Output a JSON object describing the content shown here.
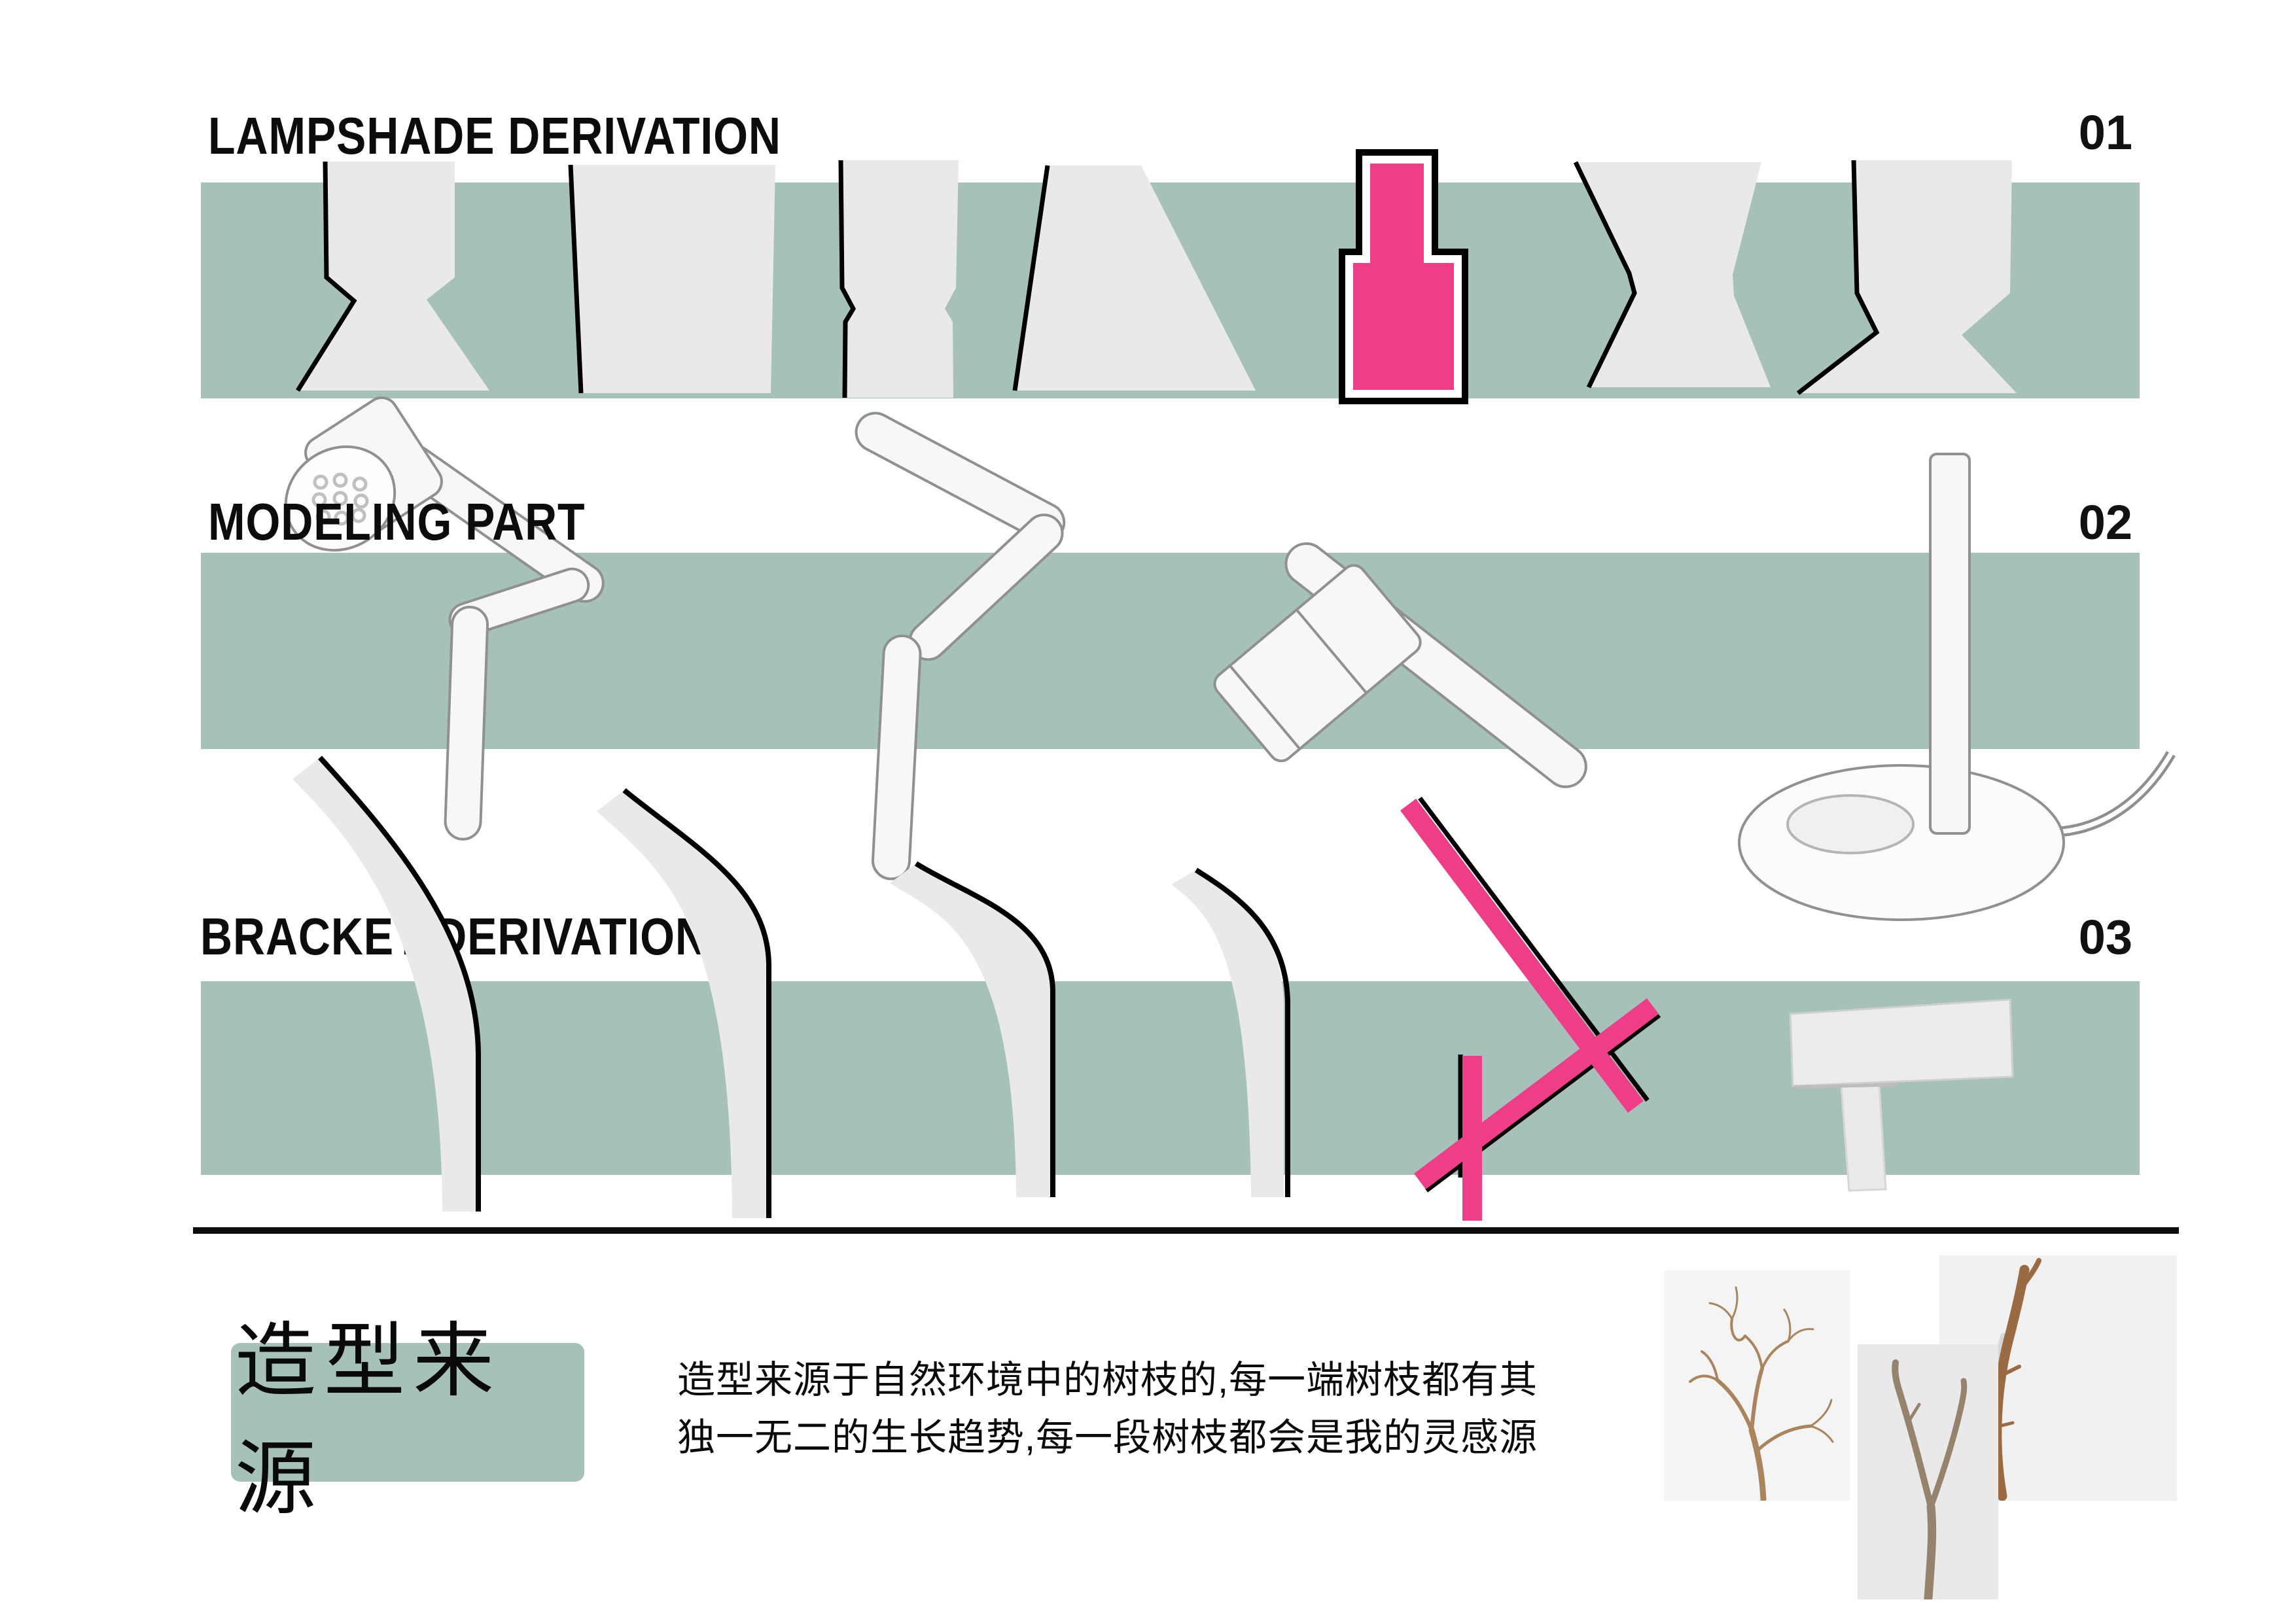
{
  "board": {
    "sections": [
      {
        "number": "01",
        "title": "LAMPSHADE DERIVATION"
      },
      {
        "number": "02",
        "title": "MODELING PART"
      },
      {
        "number": "03",
        "title": "BRACKET DERIVATION"
      }
    ],
    "footer": {
      "label": "造型来源",
      "description": [
        "造型来源于自然环境中的树枝的,每一端树枝都有其",
        "独一无二的生长趋势,每一段树枝都会是我的灵感源"
      ],
      "photos": [
        "dry-branch-many-twigs",
        "forked-y-branch",
        "single-stick-branch"
      ]
    },
    "colors": {
      "band_teal": "#a6c1ba",
      "shape_gray": "#e9e9e9",
      "highlight_pink": "#ee3e88",
      "outline_black": "#000000",
      "render_white": "#f7f7f7",
      "photo_bg_light": "#f4f4f4",
      "photo_bg_mid": "#e9e9e9",
      "branch_brown": "#a9845c"
    }
  }
}
